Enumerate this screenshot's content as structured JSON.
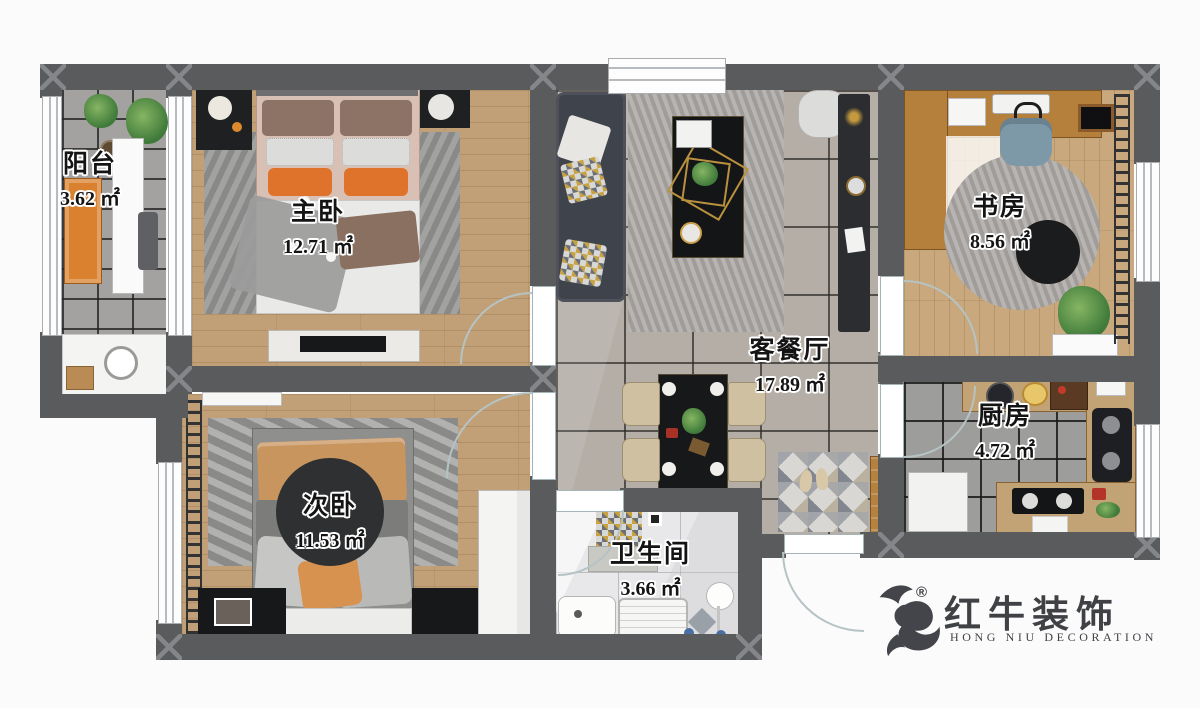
{
  "rooms": {
    "balcony": {
      "label": "阳台",
      "area": "3.62 ㎡"
    },
    "master": {
      "label": "主卧",
      "area": "12.71 ㎡"
    },
    "study": {
      "label": "书房",
      "area": "8.56 ㎡"
    },
    "living": {
      "label": "客餐厅",
      "area": "17.89 ㎡"
    },
    "kitchen": {
      "label": "厨房",
      "area": "4.72 ㎡"
    },
    "bedroom2": {
      "label": "次卧",
      "area": "11.53 ㎡"
    },
    "bathroom": {
      "label": "卫生间",
      "area": "3.66 ㎡"
    }
  },
  "logo": {
    "registered": "®",
    "brand": "红牛装饰",
    "subtitle": "HONG NIU DECORATION",
    "icon": "bull-logo-icon"
  },
  "colors": {
    "wall": "#5a5b5d",
    "accent_orange": "#dd7b2e",
    "wood_floor": "#c2a077",
    "living_tile": "#b4aea7",
    "kitchen_tile": "#9d9d9b",
    "bath_marble": "#e8e8ea",
    "logo_gray": "#3f4145"
  }
}
